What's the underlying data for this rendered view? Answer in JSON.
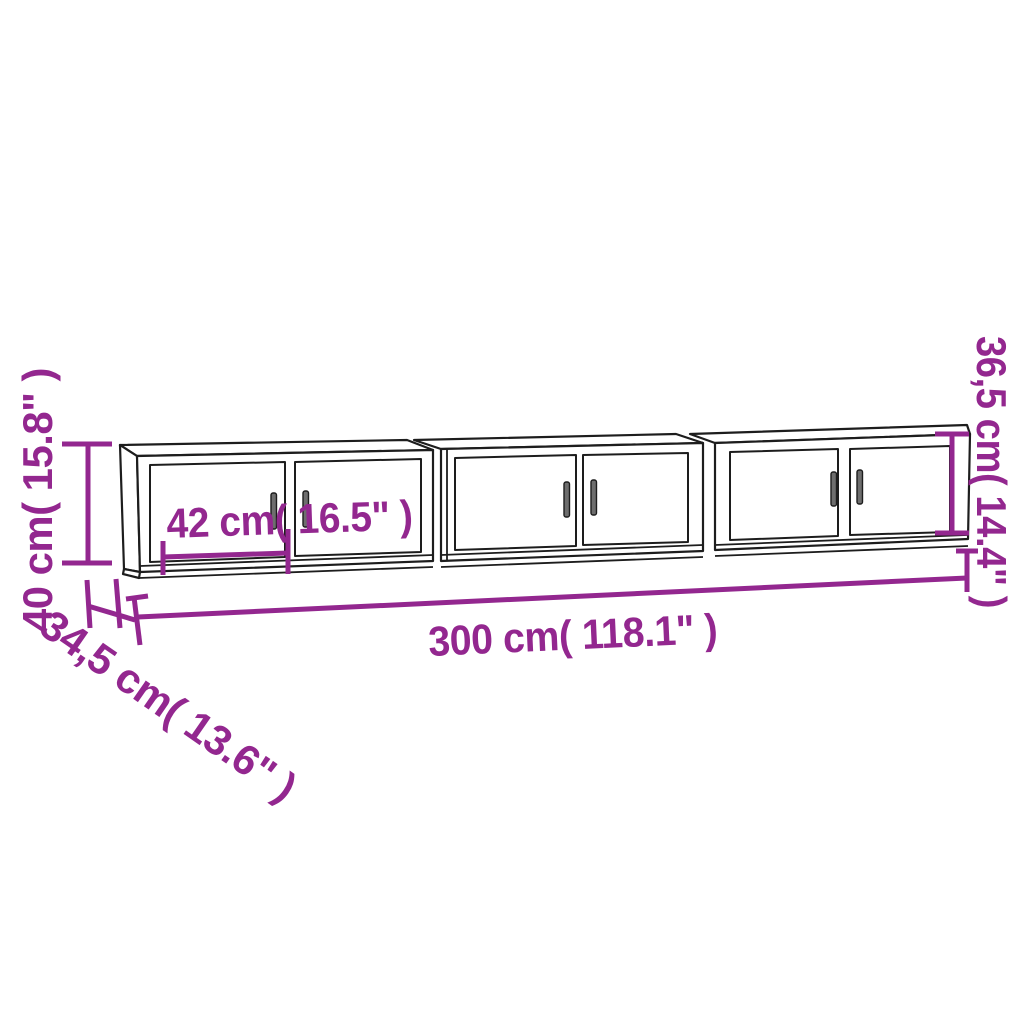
{
  "diagram": {
    "kind": "furniture-dimension-line-drawing",
    "subject": "Set of 3 wall-mounted TV cabinets, front three-quarter view",
    "cabinet_count": 3,
    "background_color": "#ffffff",
    "colors": {
      "dimension_accent": "#93278F",
      "cabinet_outline": "#1d1d1d",
      "handle_fill": "#6e6e6e",
      "surface": "#ffffff"
    },
    "dimensions": {
      "overall_height": {
        "label": "40 cm( 15.8\" )",
        "cm": "40",
        "inches": "15.8",
        "placement": "left edge, rotated vertical"
      },
      "depth": {
        "label": "34,5 cm( 13.6\" )",
        "cm": "34,5",
        "inches": "13.6",
        "placement": "lower left, diagonal"
      },
      "overall_width": {
        "label": "300 cm( 118.1\" )",
        "cm": "300",
        "inches": "118.1",
        "placement": "below cabinets, horizontal"
      },
      "door_width": {
        "label": "42 cm( 16.5\" )",
        "cm": "42",
        "inches": "16.5",
        "placement": "inside left cabinet"
      },
      "cabinet_front_height": {
        "label": "36,5 cm( 14.4\" )",
        "cm": "36,5",
        "inches": "14.4",
        "placement": "right edge, rotated vertical"
      }
    }
  }
}
